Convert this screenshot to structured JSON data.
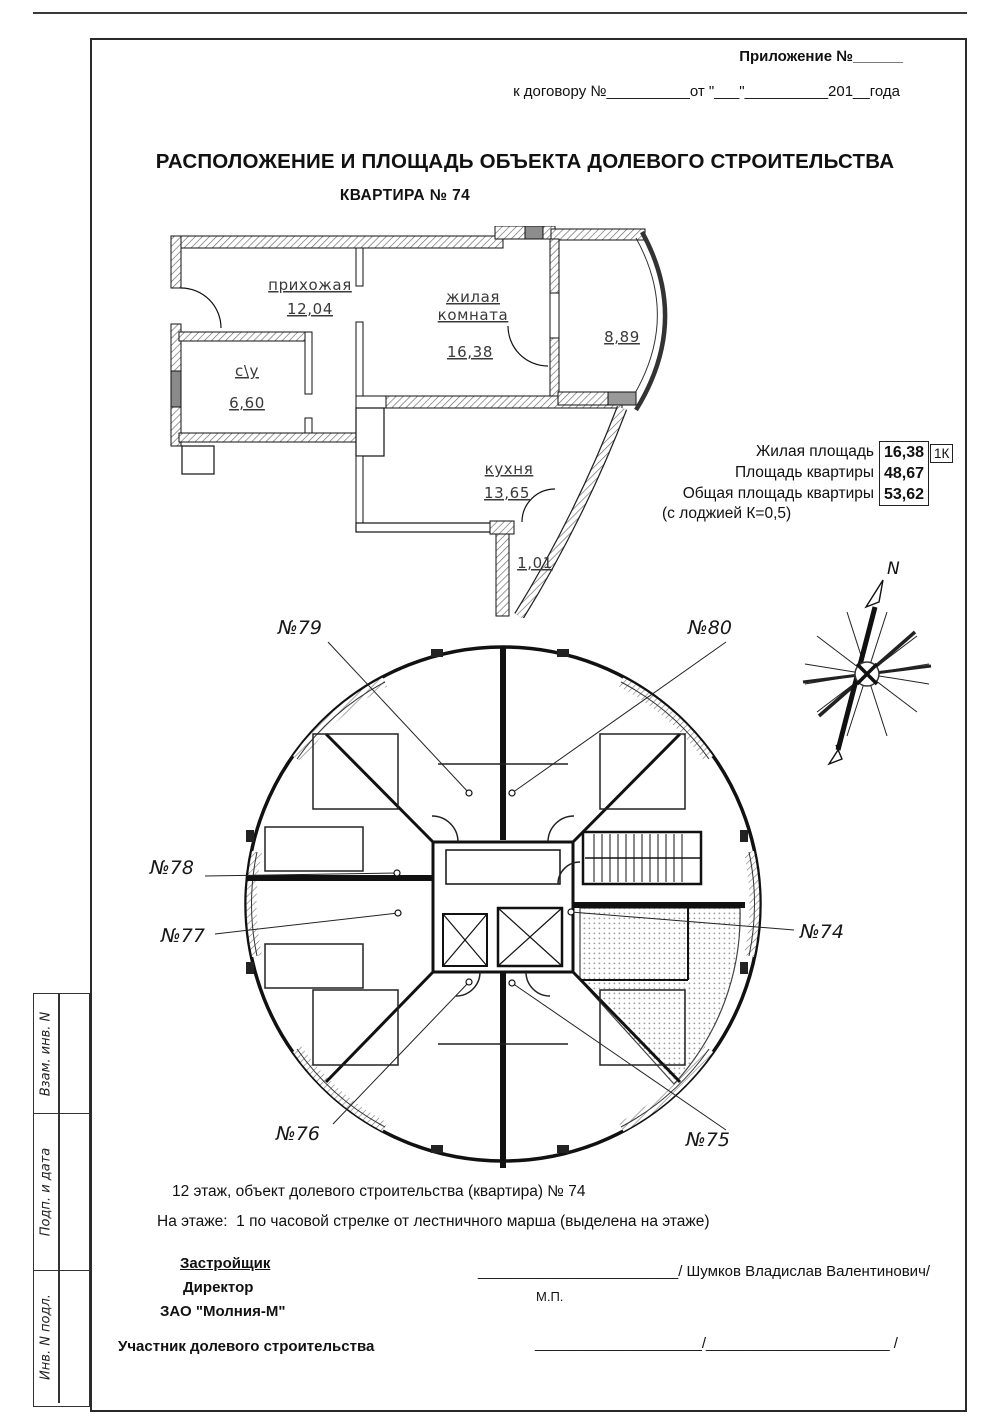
{
  "header": {
    "appendix": "Приложение №______",
    "contract": "к договору №__________от \"___\"__________201__года"
  },
  "title": {
    "main": "РАСПОЛОЖЕНИЕ И ПЛОЩАДЬ ОБЪЕКТА ДОЛЕВОГО СТРОИТЕЛЬСТВА",
    "subtitle": "КВАРТИРА № 74"
  },
  "apartment_plan": {
    "hallway_label": "прихожая",
    "hallway_area": "12,04",
    "living_label1": "жилая",
    "living_label2": "комната",
    "living_area": "16,38",
    "bath_label": "с\\у",
    "bath_area": "6,60",
    "kitchen_label": "кухня",
    "kitchen_area": "13,65",
    "loggia_area": "8,89",
    "balcony_area": "1,01"
  },
  "summary": {
    "rows": [
      {
        "label": "Жилая площадь",
        "value": "16,38"
      },
      {
        "label": "Площадь квартиры",
        "value": "48,67"
      },
      {
        "label": "Общая площадь квартиры",
        "value": "53,62"
      }
    ],
    "badge": "1К",
    "note": "(с лоджией К=0,5)"
  },
  "compass": {
    "north": "N"
  },
  "floor_plan": {
    "units": {
      "u74": "№74",
      "u75": "№75",
      "u76": "№76",
      "u77": "№77",
      "u78": "№78",
      "u79": "№79",
      "u80": "№80"
    }
  },
  "notes": {
    "line1": "12 этаж, объект долевого строительства (квартира) № 74",
    "line2": "На этаже:  1 по часовой стрелке от лестничного марша (выделена на этаже)"
  },
  "signatures": {
    "developer_heading": "Застройщик",
    "developer_title": "Директор",
    "developer_company": "ЗАО \"Молния-М\"",
    "developer_blank": "________________________",
    "developer_name": "/ Шумков Владислав Валентинович/",
    "seal": "М.П.",
    "participant_label": "Участник долевого строительства",
    "participant_blank": "____________________/______________________ /"
  },
  "sidebar": {
    "row1": "Взам. инв. N",
    "row2": "Подп. и дата",
    "row3": "Инв. N подл."
  }
}
